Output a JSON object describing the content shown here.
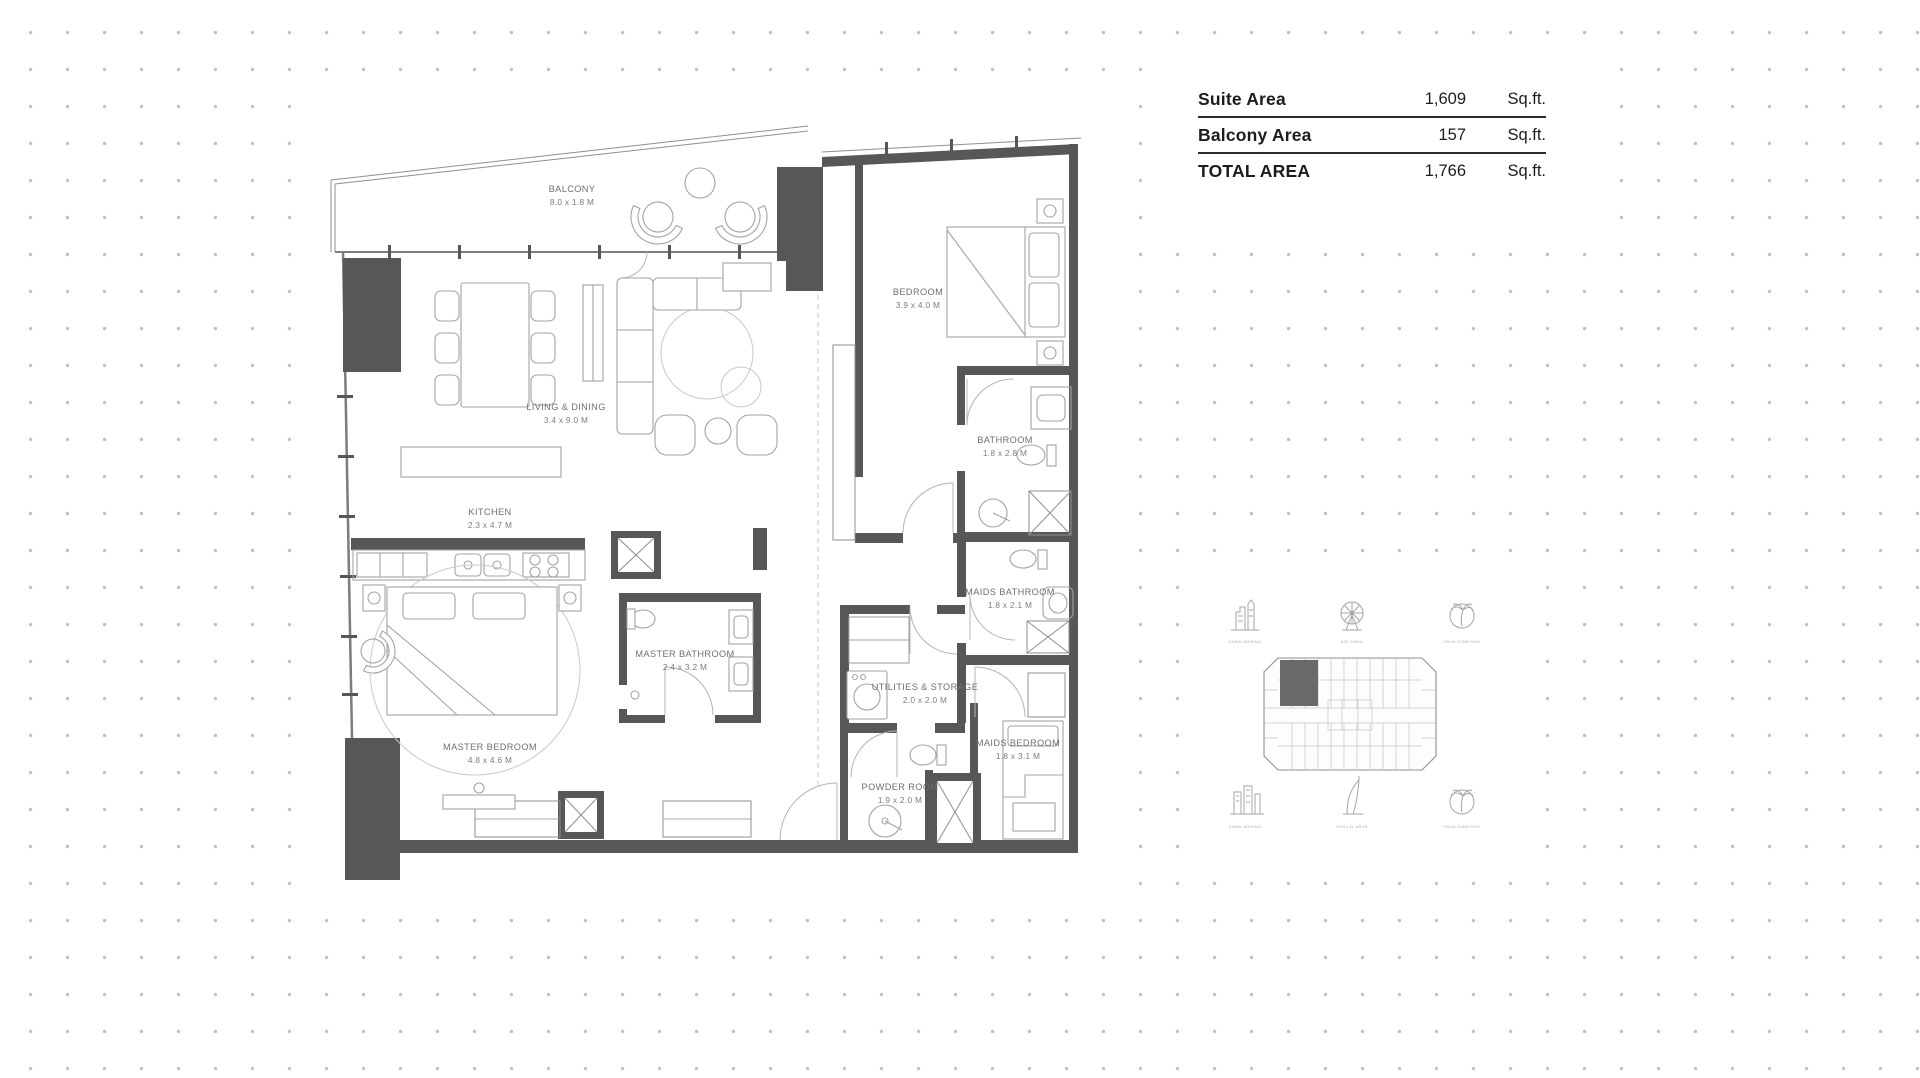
{
  "area_table": {
    "rows": [
      {
        "label": "Suite Area",
        "value": "1,609",
        "unit": "Sq.ft."
      },
      {
        "label": "Balcony Area",
        "value": "157",
        "unit": "Sq.ft."
      },
      {
        "label": "TOTAL AREA",
        "value": "1,766",
        "unit": "Sq.ft."
      }
    ]
  },
  "floorplan": {
    "rooms": [
      {
        "name": "BALCONY",
        "dims": "8.0 x 1.8 M"
      },
      {
        "name": "LIVING & DINING",
        "dims": "3.4 x 9.0 M"
      },
      {
        "name": "KITCHEN",
        "dims": "2.3 x 4.7 M"
      },
      {
        "name": "MASTER BEDROOM",
        "dims": "4.8 x 4.6 M"
      },
      {
        "name": "MASTER BATHROOM",
        "dims": "2.4 x 3.2 M"
      },
      {
        "name": "BEDROOM",
        "dims": "3.9 x 4.0 M"
      },
      {
        "name": "BATHROOM",
        "dims": "1.8 x 2.8 M"
      },
      {
        "name": "MAIDS BATHROOM",
        "dims": "1.8 x 2.1 M"
      },
      {
        "name": "UTILITIES & STORAGE",
        "dims": "2.0 x 2.0 M"
      },
      {
        "name": "MAIDS BEDROOM",
        "dims": "1.8 x 3.1 M"
      },
      {
        "name": "POWDER ROOM",
        "dims": "1.9 x 2.0 M"
      }
    ]
  },
  "key_plan": {
    "top_landmarks": [
      {
        "icon": "city-skyline-icon",
        "label": "DUBAI MARINA"
      },
      {
        "icon": "ferris-wheel-icon",
        "label": "AIN DUBAI"
      },
      {
        "icon": "palm-tree-icon",
        "label": "PALM JUMEIRAH"
      }
    ],
    "bottom_landmarks": [
      {
        "icon": "towers-icon",
        "label": "DUBAI MARINA"
      },
      {
        "icon": "burj-al-arab-icon",
        "label": "BURJ AL ARAB"
      },
      {
        "icon": "palm-tree-icon",
        "label": "PALM JUMEIRAH"
      }
    ]
  },
  "colors": {
    "wall": "#575757",
    "furniture_line": "#a3a3a3",
    "label_text": "#6f6f6f",
    "dot": "#c1c1c1",
    "table_text": "#1c1c1c"
  }
}
